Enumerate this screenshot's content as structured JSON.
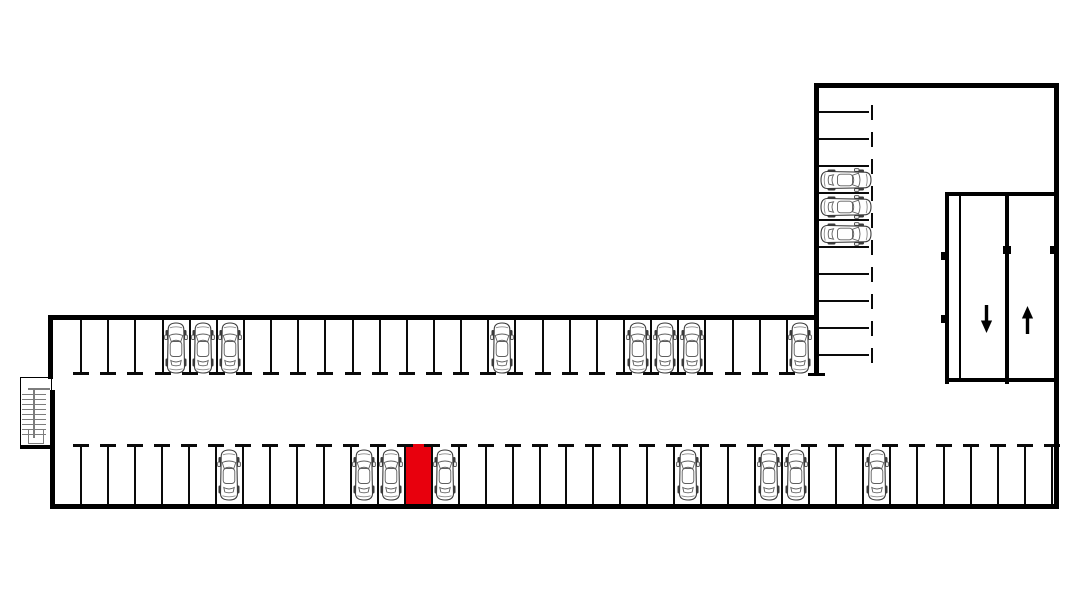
{
  "diagram": {
    "type": "parking-garage-floor-plan",
    "canvas": {
      "width": 1080,
      "height": 592,
      "background": "#ffffff"
    },
    "colors": {
      "wall": "#000000",
      "divider": "#0a0a0a",
      "highlight": "#e8000d",
      "car_outline": "#3a3a3a",
      "car_detail": "#5f5f5f",
      "car_light_detail": "#8b8b8b",
      "stair_line": "#7d7d7d",
      "arrow": "#000000"
    },
    "divider_style": {
      "stem_thickness": 2,
      "cap_length": 16,
      "cap_thickness": 3
    },
    "rows": {
      "upper": {
        "name": "upper-row",
        "x0": 54,
        "x1": 814,
        "space_count": 28,
        "bay_top": 318,
        "bay_height": 57,
        "stall_top": 320,
        "stall_depth": 54,
        "car_top": 321,
        "end_divider": false,
        "occupied": [
          5,
          6,
          7,
          17,
          22,
          23,
          24,
          28
        ],
        "highlighted": []
      },
      "lower": {
        "name": "lower-row",
        "x0": 54,
        "x1": 1052,
        "space_count": 37,
        "bay_top": 445,
        "bay_height": 59,
        "stall_top": 446,
        "stall_depth": 58,
        "car_top": 448,
        "end_divider": true,
        "occupied": [
          7,
          12,
          13,
          15,
          24,
          27,
          28,
          31
        ],
        "highlighted": [
          14
        ]
      },
      "wing": {
        "name": "wing-column",
        "wall_x": 819,
        "line_length": 50,
        "cap_offset": 52,
        "cap_length": 15,
        "boundaries": [
          85,
          112,
          139,
          166,
          193,
          220,
          247,
          274,
          301,
          328,
          355
        ],
        "bay_width": 55,
        "car_x": 819,
        "occupied": [
          4,
          5,
          6
        ],
        "highlighted": []
      }
    },
    "summary": {
      "total_spaces": 75,
      "occupied_spaces": 19,
      "free_spaces": 55,
      "highlighted_spaces": 1
    },
    "ramp": {
      "lanes": [
        {
          "name": "down-lane",
          "direction": "down",
          "symbol": "↓",
          "x": 961,
          "y": 196,
          "w": 44,
          "h": 182,
          "arrow_x": 980,
          "arrow_y": 305
        },
        {
          "name": "up-lane",
          "direction": "up",
          "symbol": "↑",
          "x": 1009,
          "y": 196,
          "w": 45,
          "h": 182,
          "arrow_x": 1021,
          "arrow_y": 306
        }
      ]
    },
    "walls": [
      {
        "name": "outer-top-wall",
        "x": 48,
        "y": 315,
        "w": 771,
        "h": 5
      },
      {
        "name": "outer-left-wall-upper",
        "x": 48,
        "y": 315,
        "w": 5,
        "h": 64
      },
      {
        "name": "outer-left-wall-lower",
        "x": 50,
        "y": 390,
        "w": 5,
        "h": 119
      },
      {
        "name": "outer-bottom-wall",
        "x": 50,
        "y": 504,
        "w": 1009,
        "h": 5
      },
      {
        "name": "outer-right-wall",
        "x": 1054,
        "y": 83,
        "w": 5,
        "h": 426
      },
      {
        "name": "wing-top-wall",
        "x": 814,
        "y": 83,
        "w": 245,
        "h": 5
      },
      {
        "name": "wing-left-wall",
        "x": 814,
        "y": 83,
        "w": 5,
        "h": 293
      },
      {
        "name": "wing-left-wall-cap",
        "x": 808,
        "y": 373,
        "w": 17,
        "h": 3
      },
      {
        "name": "ramp-left-wall",
        "x": 945,
        "y": 192,
        "w": 4,
        "h": 192
      },
      {
        "name": "ramp-top-wall",
        "x": 945,
        "y": 192,
        "w": 114,
        "h": 4
      },
      {
        "name": "ramp-bottom-wall",
        "x": 945,
        "y": 378,
        "w": 114,
        "h": 4
      },
      {
        "name": "ramp-lane-line-thin",
        "x": 959,
        "y": 194,
        "w": 2,
        "h": 188
      },
      {
        "name": "ramp-lane-line-thick",
        "x": 1005,
        "y": 194,
        "w": 4,
        "h": 190
      },
      {
        "name": "ramp-wall-tab-upper",
        "x": 941,
        "y": 252,
        "w": 8,
        "h": 8
      },
      {
        "name": "ramp-wall-tab-lower",
        "x": 941,
        "y": 315,
        "w": 8,
        "h": 8
      },
      {
        "name": "ramp-center-tab",
        "x": 1003,
        "y": 246,
        "w": 8,
        "h": 8
      },
      {
        "name": "right-wall-tab",
        "x": 1050,
        "y": 246,
        "w": 6,
        "h": 8
      }
    ],
    "stairs": {
      "box": {
        "x": 20,
        "y": 377,
        "w": 32,
        "h": 71
      },
      "treads": {
        "x": 22,
        "w": 24,
        "count": 9,
        "y_start": 394,
        "step": 5
      },
      "mid_rail": {
        "x": 33,
        "y": 388,
        "w": 1.5,
        "h": 50
      },
      "landing_rail": {
        "x": 28,
        "y": 388,
        "w": 22,
        "h": 1.5
      },
      "inner_box": {
        "x": 28,
        "y": 429,
        "w": 16,
        "h": 15
      },
      "bottom_edge": {
        "x": 20,
        "y": 445,
        "w": 32,
        "h": 3.5
      }
    }
  }
}
